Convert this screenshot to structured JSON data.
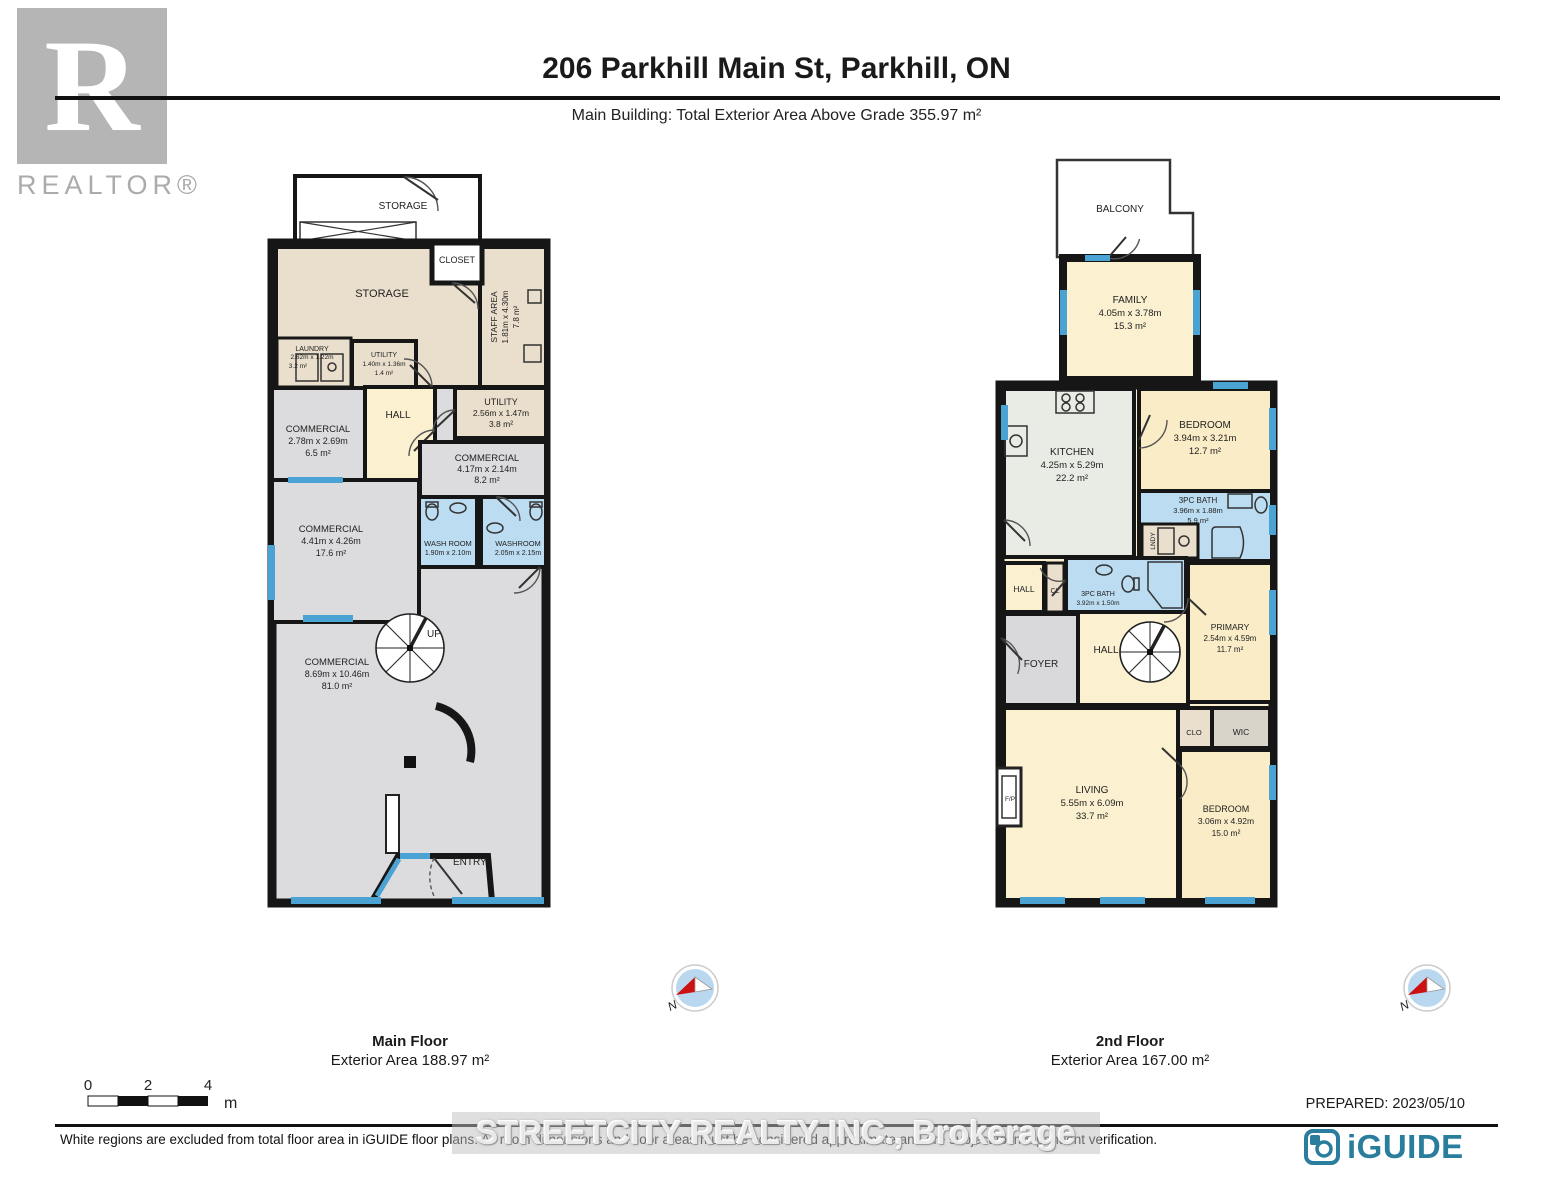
{
  "header": {
    "realtor_letter": "R",
    "realtor_label": "REALTOR®",
    "title": "206 Parkhill Main St, Parkhill, ON",
    "subtitle": "Main Building: Total Exterior Area Above Grade 355.97 m²"
  },
  "main_floor": {
    "caption_title": "Main Floor",
    "caption_area": "Exterior Area 188.97 m²",
    "rooms": {
      "storage_ext": {
        "name": "STORAGE"
      },
      "storage": {
        "name": "STORAGE"
      },
      "closet": {
        "name": "CLOSET"
      },
      "staff_area": {
        "name": "STAFF AREA",
        "dims": "1.81m x 4.30m",
        "area": "7.8 m²"
      },
      "laundry": {
        "name": "LAUNDRY",
        "dims": "2.62m x 1.22m",
        "area": "3.2 m²"
      },
      "utility_small": {
        "name": "UTILITY",
        "dims": "1.40m x 1.36m",
        "area": "1.4 m²"
      },
      "commercial_1": {
        "name": "COMMERCIAL",
        "dims": "2.78m x 2.69m",
        "area": "6.5 m²"
      },
      "hall": {
        "name": "HALL"
      },
      "utility": {
        "name": "UTILITY",
        "dims": "2.56m x 1.47m",
        "area": "3.8 m²"
      },
      "commercial_2": {
        "name": "COMMERCIAL",
        "dims": "4.17m x 2.14m",
        "area": "8.2 m²"
      },
      "commercial_3": {
        "name": "COMMERCIAL",
        "dims": "4.41m x 4.26m",
        "area": "17.6 m²"
      },
      "washroom_1": {
        "name": "WASH ROOM",
        "dims": "1.90m x 2.10m"
      },
      "washroom_2": {
        "name": "WASHROOM",
        "dims": "2.05m x 2.15m"
      },
      "commercial_4": {
        "name": "COMMERCIAL",
        "dims": "8.69m x 10.46m",
        "area": "81.0 m²"
      },
      "stairs_up": {
        "name": "UP"
      },
      "entry": {
        "name": "ENTRY"
      }
    }
  },
  "second_floor": {
    "caption_title": "2nd Floor",
    "caption_area": "Exterior Area 167.00 m²",
    "rooms": {
      "balcony": {
        "name": "BALCONY"
      },
      "family": {
        "name": "FAMILY",
        "dims": "4.05m x 3.78m",
        "area": "15.3 m²"
      },
      "kitchen": {
        "name": "KITCHEN",
        "dims": "4.25m x 5.29m",
        "area": "22.2 m²"
      },
      "bedroom_1": {
        "name": "BEDROOM",
        "dims": "3.94m x 3.21m",
        "area": "12.7 m²"
      },
      "bath_1": {
        "name": "3PC BATH",
        "dims": "3.96m x 1.88m",
        "area": "5.9 m²"
      },
      "lndy": {
        "name": "LNDY"
      },
      "hall_small": {
        "name": "HALL"
      },
      "cl": {
        "name": "CL"
      },
      "bath_2": {
        "name": "3PC BATH",
        "dims": "3.92m x 1.50m"
      },
      "foyer": {
        "name": "FOYER"
      },
      "hall_dn": {
        "name": "HALL"
      },
      "stairs_dn": {
        "name": "DN"
      },
      "primary": {
        "name": "PRIMARY",
        "dims": "2.54m x 4.59m",
        "area": "11.7 m²"
      },
      "clo": {
        "name": "CLO"
      },
      "wic": {
        "name": "WIC"
      },
      "living": {
        "name": "LIVING",
        "dims": "5.55m x 6.09m",
        "area": "33.7 m²"
      },
      "fireplace": {
        "name": "F/P"
      },
      "bedroom_2": {
        "name": "BEDROOM",
        "dims": "3.06m x 4.92m",
        "area": "15.0 m²"
      }
    }
  },
  "compass": {
    "label": "N"
  },
  "scale_bar": {
    "tick_0": "0",
    "tick_2": "2",
    "tick_4": "4",
    "unit": "m"
  },
  "footer": {
    "prepared": "PREPARED: 2023/05/10",
    "disclaimer": "White regions are excluded from total floor area in iGUIDE floor plans. All room dimensions and floor areas must be considered approximate and are subject to independent verification.",
    "brand": "iGUIDE"
  },
  "watermark": "STREETCITY REALTY INC.,  Brokerage",
  "colors": {
    "wall": "#161616",
    "commercial_gray": "#dcdcde",
    "storage_tan": "#e9dfcc",
    "room_cream": "#fbf0d0",
    "bedroom_cream": "#f9ecc7",
    "bath_blue": "#bcdcf1",
    "kitchen_sage": "#e9ece4",
    "window_blue": "#4ba3d3",
    "brand_teal": "#2a7d9c"
  }
}
